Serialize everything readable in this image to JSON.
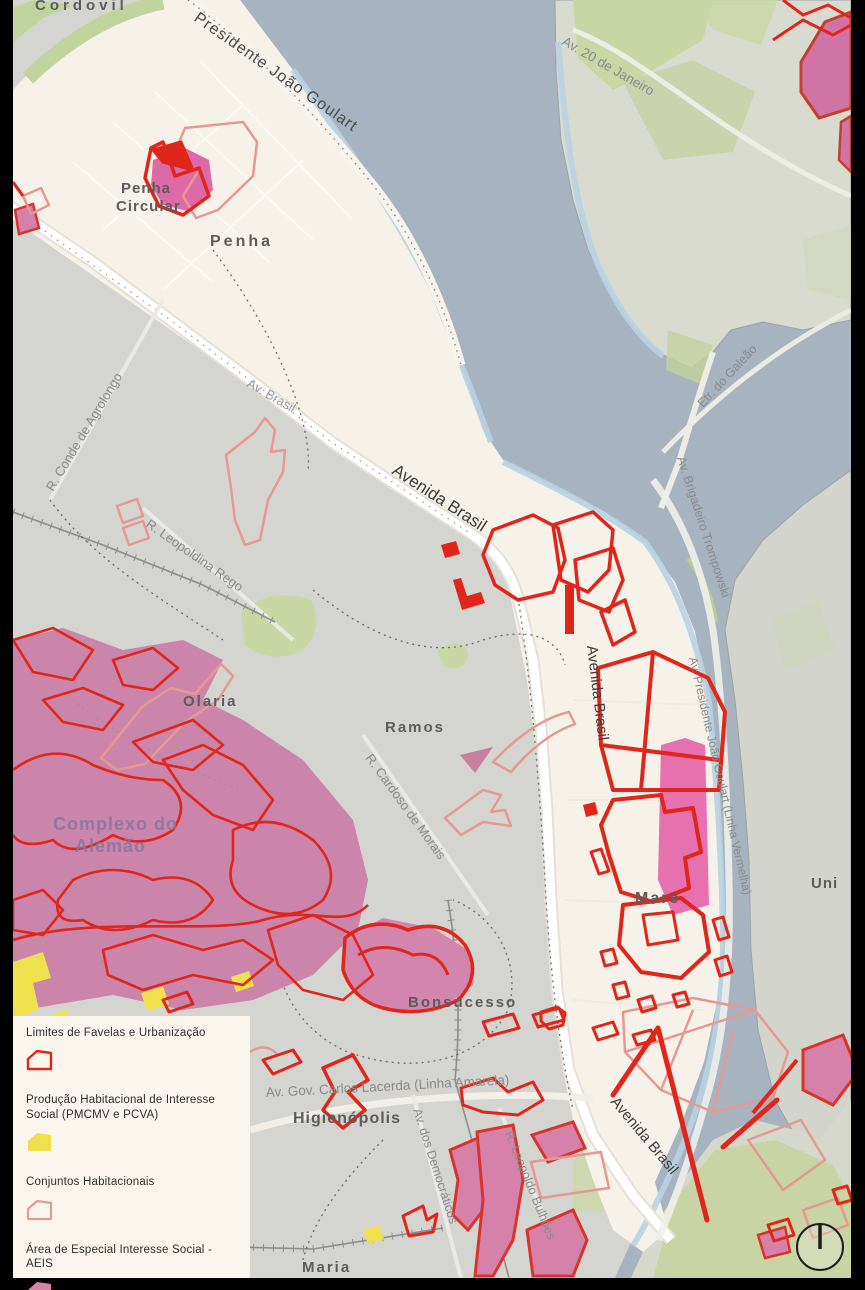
{
  "map": {
    "neighborhoods": {
      "cordovil": "Cordovil",
      "penha_circular_line1": "Penha",
      "penha_circular_line2": "Circular",
      "penha": "Penha",
      "olaria": "Olaria",
      "ramos": "Ramos",
      "alemao_line1": "Complexo do",
      "alemao_line2": "Alemão",
      "mare": "Maré",
      "bonsucesso": "Bonsucesso",
      "higienopolis": "Higienópolis",
      "maria_line1": "Maria",
      "maria_line2": "da Graça",
      "universidade": "Uni"
    },
    "roads": {
      "presidente_joao_goulart": "Presidente João Goulart",
      "av_20_de_janeiro": "Av. 20 de Janeiro",
      "etr_do_galeao": "Etr. do Galeão",
      "brigadeiro_trompowski": "Av. Brigadeiro Trompowski",
      "av_brasil_short": "Av. Brasil",
      "avenida_brasil": "Avenida Brasil",
      "conde_de_agrolongo": "R. Conde de Agrolongo",
      "leopoldina_rego": "R. Leopoldina Rego",
      "cardoso_de_morais": "R. Cardoso de Morais",
      "linha_vermelha": "Av. Presidente João Goulart (Linha Vermelha)",
      "linha_amarela": "Av. Gov. Carlos Lacerda (Linha Amarela)",
      "democraticos": "Av. dos Democráticos",
      "leopoldo_bulhoes": "R. Leopoldo Bulhões"
    },
    "colors": {
      "water": "#a7b4bf",
      "mainland": "#d4d4d1",
      "island": "#d9dbd1",
      "urban_cream": "#f7f2e9",
      "green": "#c9d7a4",
      "favela_red": "#e0251b",
      "conjunto_salmon": "#e59992",
      "aeis_pink": "#d581a9",
      "pmcmv_yellow": "#efe14e"
    }
  },
  "legend": {
    "items": [
      {
        "label": "Limites de Favelas e Urbanização",
        "swatch": "red-outline",
        "color": "#e0251b"
      },
      {
        "label": "Produção Habitacional de Interesse Social (PMCMV e PCVA)",
        "swatch": "yellow-fill",
        "color": "#efe14e"
      },
      {
        "label": "Conjuntos Habitacionais",
        "swatch": "salmon-outline",
        "color": "#e59992"
      },
      {
        "label": "Área de Especial Interesse Social - AEIS",
        "swatch": "pink-fill",
        "color": "#d581a9"
      }
    ]
  },
  "compass": {
    "kind": "north-indicator"
  }
}
